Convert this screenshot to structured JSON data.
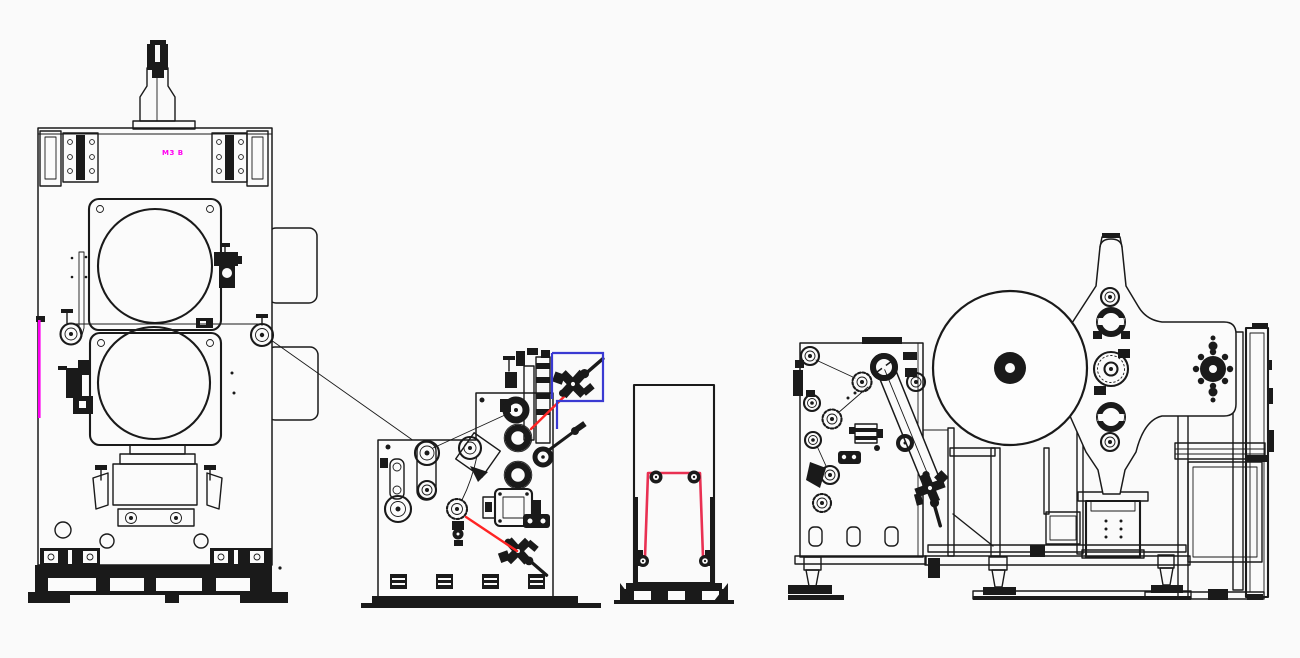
{
  "diagram": {
    "machine_tag_label": "M3 B",
    "machines": [
      {
        "id": "press-machine"
      },
      {
        "id": "coating-machine"
      },
      {
        "id": "web-stand"
      },
      {
        "id": "turret-winder"
      }
    ]
  },
  "colors": {
    "line": "#1a1a1a",
    "paper": "#fafafa",
    "paper2": "#fbfbfb",
    "paper3": "#fdfdfd",
    "red": "#ff2424",
    "red2": "#e93052",
    "blue": "#3a3ad2",
    "magenta": "#ff00f0"
  }
}
